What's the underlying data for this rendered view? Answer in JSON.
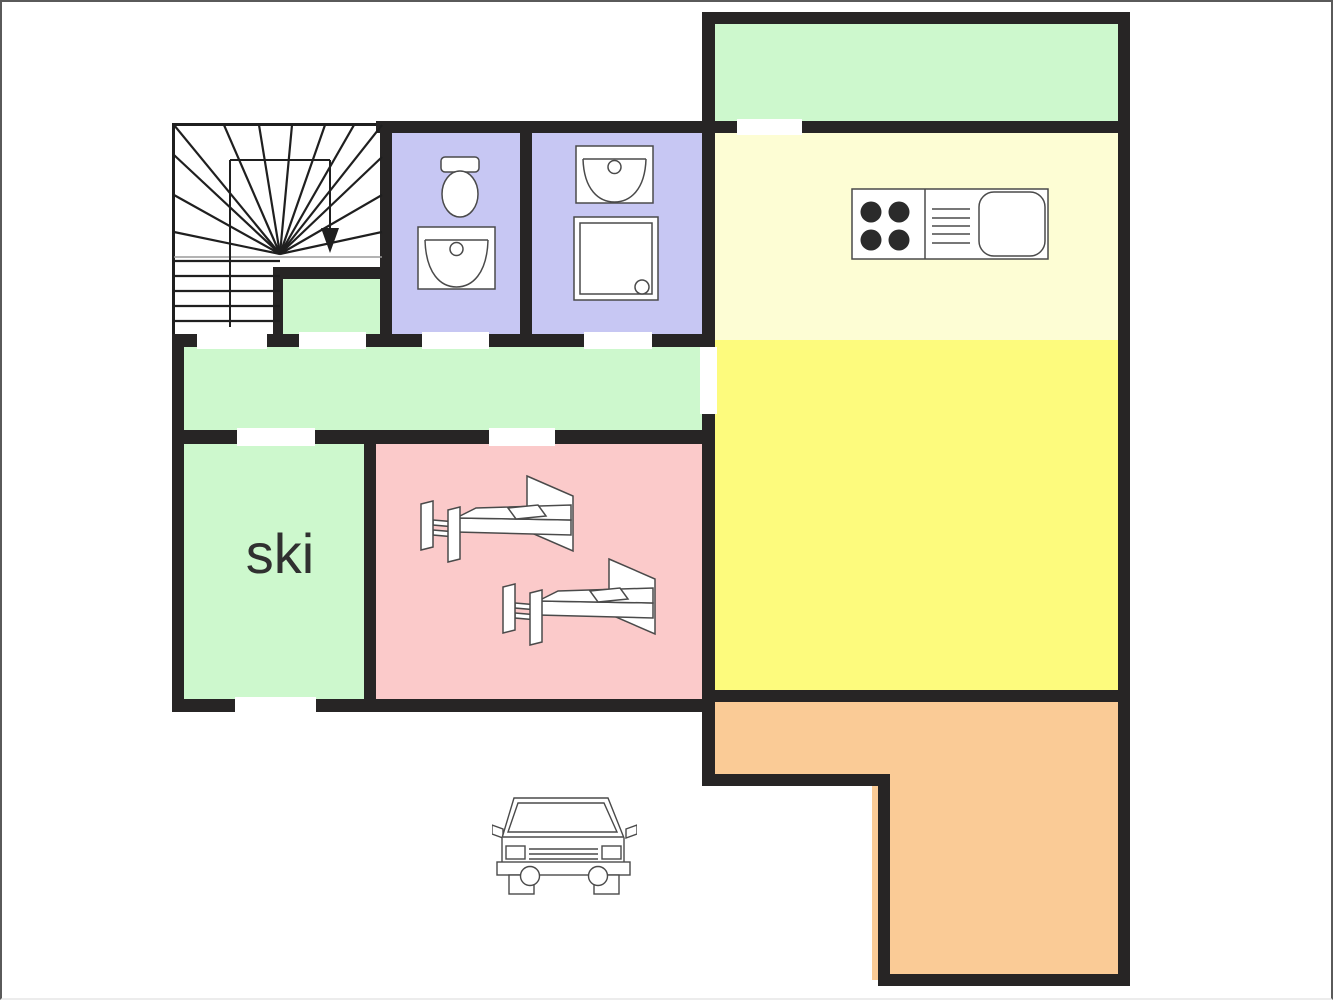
{
  "floorplan": {
    "title": "apartment-floor-plan",
    "labels": {
      "ski_room": "ski"
    },
    "colors": {
      "wall": "#272525",
      "stairs-line": "#1f1f1f",
      "room-green": "#CDF8CD",
      "room-purple": "#C7C7F3",
      "room-pink": "#FBCACA",
      "room-yellow-pale": "#FDFDD4",
      "room-yellow": "#FDFB7D",
      "room-orange": "#FACB96",
      "fixture-line": "#4a4a4a",
      "label-text": "#303030",
      "frame": "#5a5a5a"
    },
    "rooms": {
      "stairwell": {
        "label": "",
        "color_key": "white",
        "fixtures": [
          "stairs",
          "down-arrow"
        ]
      },
      "vestibule": {
        "label": "",
        "color_key": "room-green",
        "fixtures": []
      },
      "wc": {
        "label": "",
        "color_key": "room-purple",
        "fixtures": [
          "toilet",
          "washbasin"
        ]
      },
      "shower-room": {
        "label": "",
        "color_key": "room-purple",
        "fixtures": [
          "washbasin",
          "shower"
        ]
      },
      "hallway": {
        "label": "",
        "color_key": "room-green",
        "fixtures": []
      },
      "ski-room": {
        "label": "ski",
        "color_key": "room-green",
        "fixtures": []
      },
      "bedroom": {
        "label": "",
        "color_key": "room-pink",
        "fixtures": [
          "bed",
          "bed"
        ]
      },
      "balcony": {
        "label": "",
        "color_key": "room-green",
        "fixtures": []
      },
      "living-kitchen": {
        "label": "",
        "color_key": "room-yellow",
        "upper_color_key": "room-yellow-pale",
        "fixtures": [
          "stove-sink-unit"
        ]
      },
      "terrace": {
        "label": "",
        "color_key": "room-orange",
        "fixtures": []
      },
      "driveway": {
        "label": "",
        "color_key": "white",
        "fixtures": [
          "car"
        ]
      }
    },
    "icons": [
      "stairs-icon",
      "down-arrow-icon",
      "toilet-icon",
      "washbasin-icon",
      "shower-icon",
      "stove-sink-unit-icon",
      "bed-icon",
      "car-icon"
    ],
    "door_openings_count": 9
  }
}
